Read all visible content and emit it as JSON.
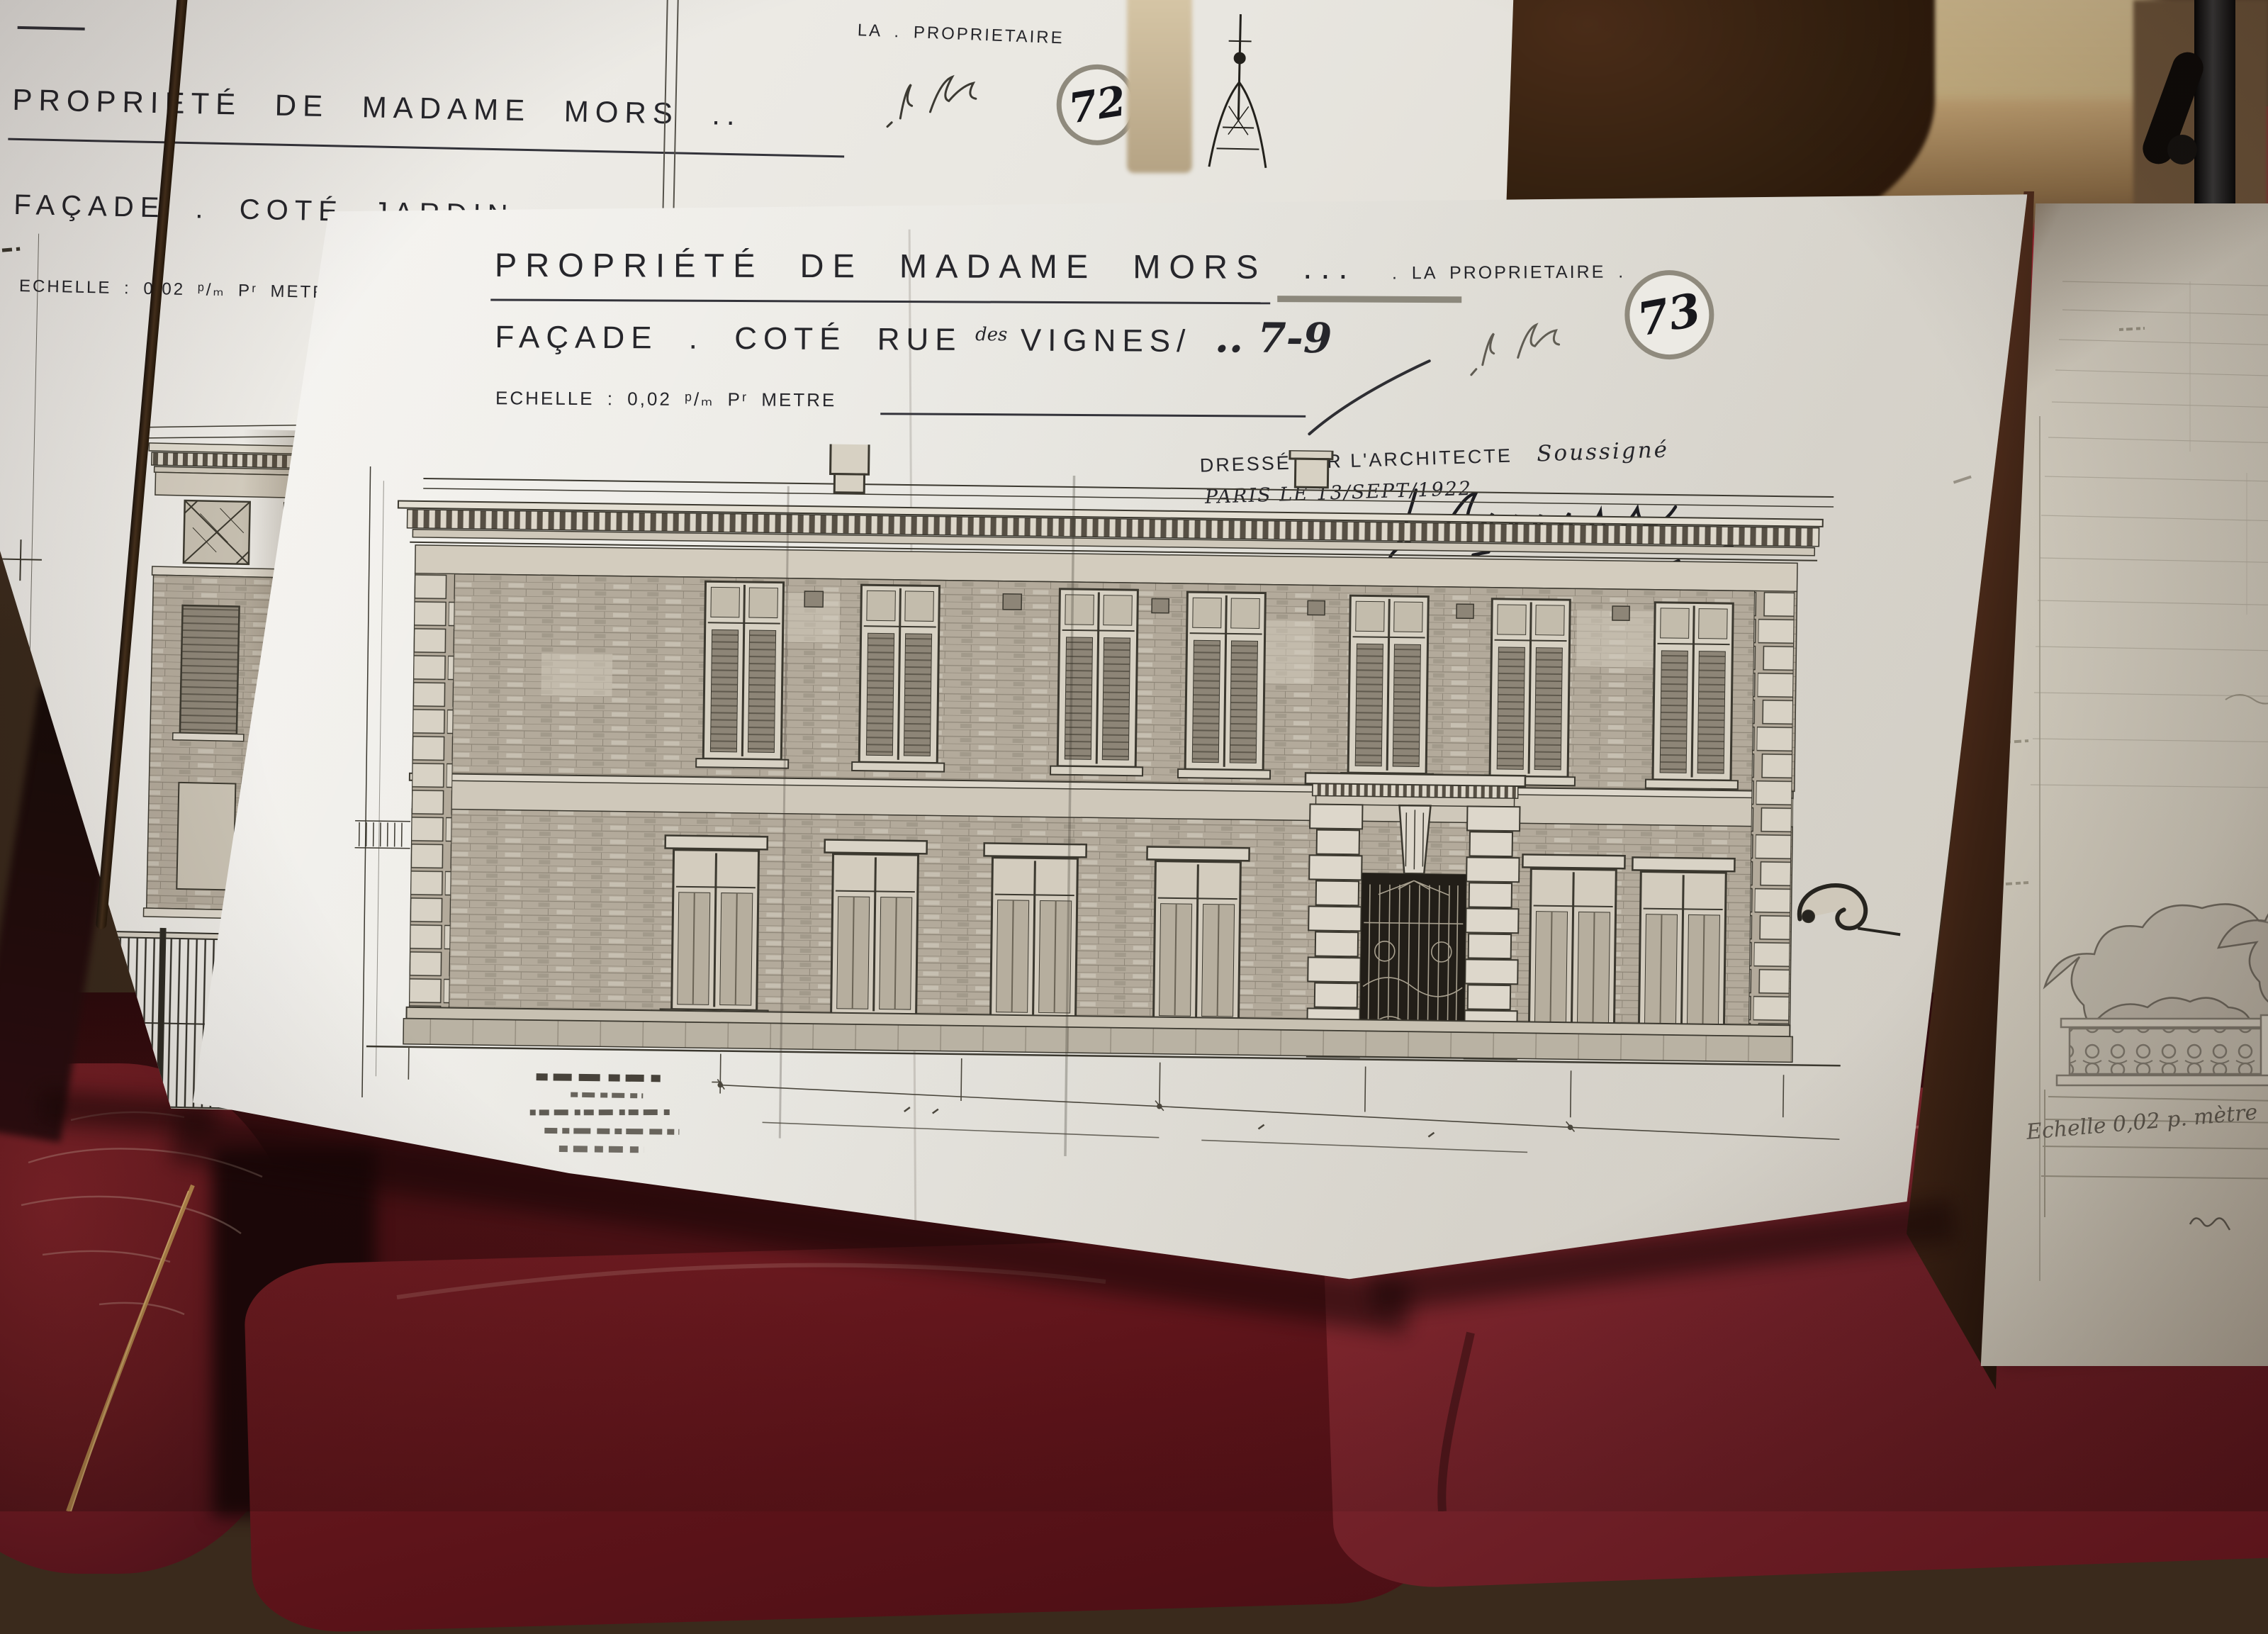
{
  "board_jardin": {
    "title": "PROPRIÉTÉ DE MADAME MORS ..",
    "subtitle": "FAÇADE . COTÉ JARDIN ..",
    "scale": "ECHELLE : 0,02 ᵖ/ₘ Pʳ METRE",
    "owner_label": "LA . PROPRIETAIRE",
    "sheet_number": "72"
  },
  "board_rue": {
    "title": "PROPRIÉTÉ DE MADAME MORS ...",
    "subtitle_prefix": "FAÇADE . COTÉ RUE",
    "subtitle_des": "des",
    "subtitle_street": "VIGNES/",
    "subtitle_numbers": ".. 7-9",
    "scale": "ECHELLE : 0,02 ᵖ/ₘ Pʳ METRE",
    "owner_label": ". LA PROPRIETAIRE .",
    "sheet_number": "73",
    "attestation_line1a": "DRESSÉ PAR L'ARCHITECTE",
    "attestation_line1b": "Soussigné",
    "attestation_line2": "PARIS LE 13/SEPT/1922"
  },
  "board_garden_wall": {
    "scale_note": "Echelle 0,02 p. mètre"
  },
  "colors": {
    "board_white": "#eeece7",
    "ink": "#26262a",
    "cushion_red": "#6e1c22",
    "bench_red": "#a32233",
    "drawing_brick": "#b3aa9b"
  }
}
